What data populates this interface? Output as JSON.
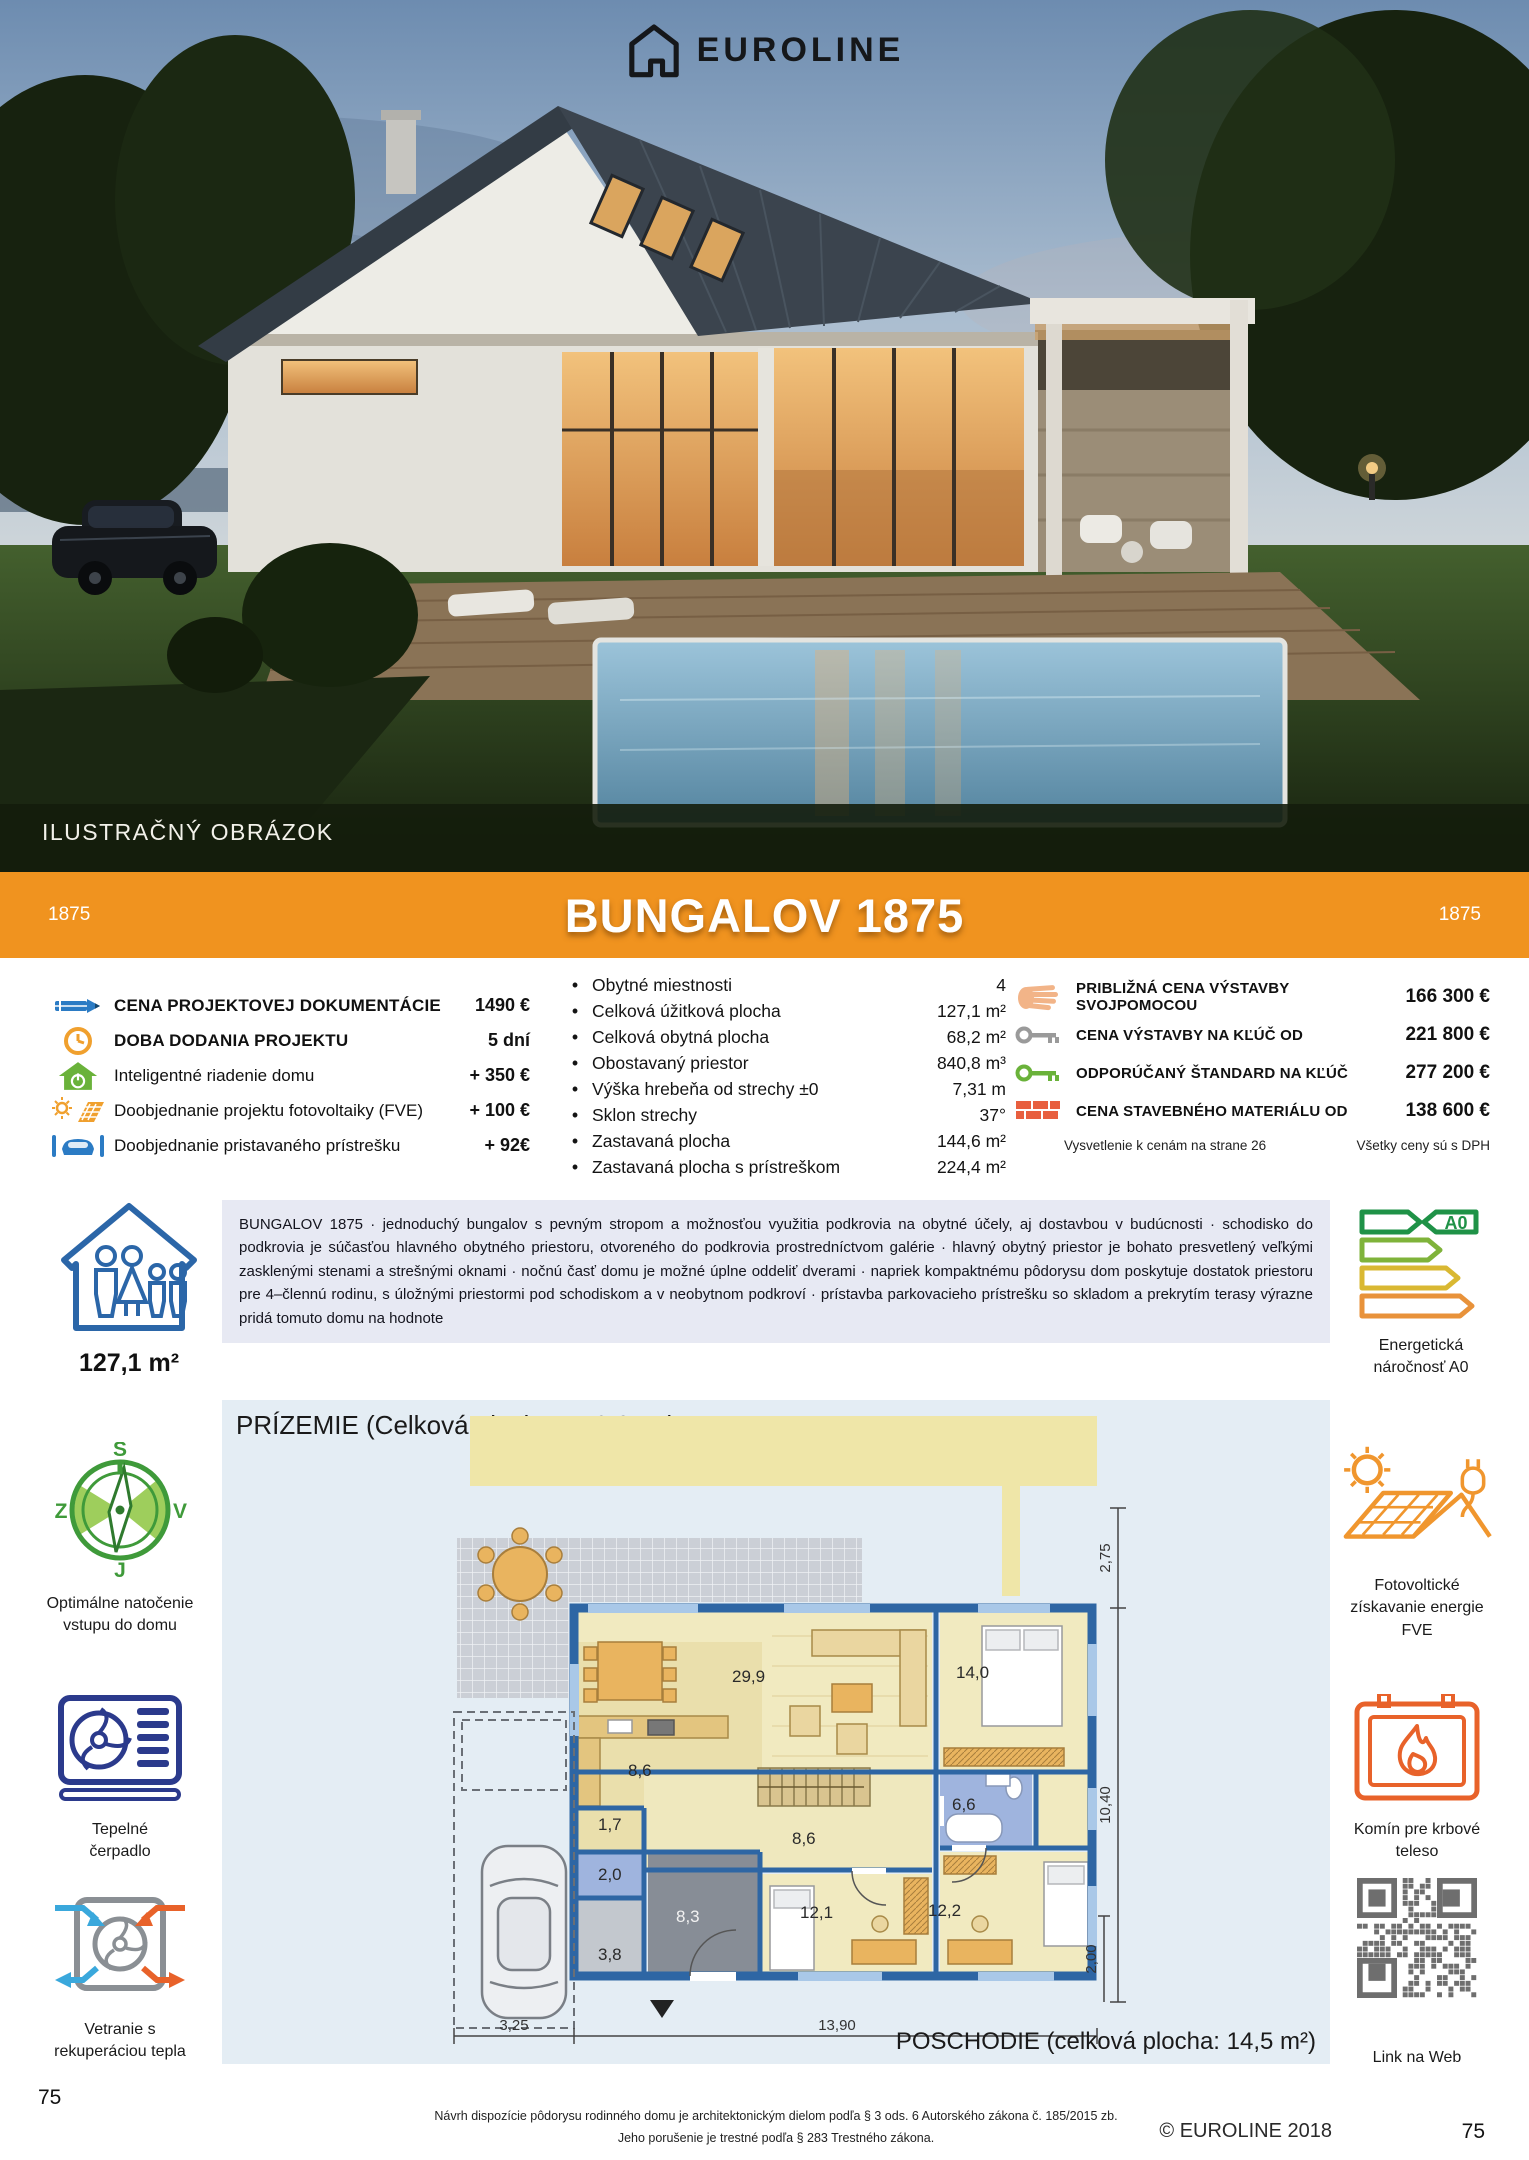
{
  "hero": {
    "brand": "EUROLINE",
    "caption": "ILUSTRAČNÝ OBRÁZOK"
  },
  "banner": {
    "code_left": "1875",
    "title": "BUNGALOV 1875",
    "code_right": "1875",
    "color": "#F0931F"
  },
  "pricing_left": {
    "items": [
      {
        "icon": "pencil-icon",
        "label": "CENA PROJEKTOVEJ DOKUMENTÁCIE",
        "value": "1490 €"
      },
      {
        "icon": "clock-icon",
        "label": "DOBA DODANIA PROJEKTU",
        "value": "5 dní"
      },
      {
        "icon": "smart-home-icon",
        "label": "Inteligentné riadenie domu",
        "value": "+ 350 €"
      },
      {
        "icon": "solar-panel-icon",
        "label": "Doobjednanie projektu fotovoltaiky (FVE)",
        "value": "+ 100 €"
      },
      {
        "icon": "carport-icon",
        "label": "Doobjednanie pristavaného prístrešku",
        "value": "+ 92€"
      }
    ]
  },
  "specs": {
    "items": [
      {
        "label": "Obytné miestnosti",
        "value": "4"
      },
      {
        "label": "Celková úžitková plocha",
        "value": "127,1 m²"
      },
      {
        "label": "Celková obytná plocha",
        "value": "68,2 m²"
      },
      {
        "label": "Obostavaný priestor",
        "value": "840,8 m³"
      },
      {
        "label": "Výška hrebeňa od strechy ±0",
        "value": "7,31 m"
      },
      {
        "label": "Sklon strechy",
        "value": "37°"
      },
      {
        "label": "Zastavaná plocha",
        "value": "144,6 m²"
      },
      {
        "label": "Zastavaná plocha s prístreškom",
        "value": "224,4 m²"
      }
    ]
  },
  "pricing_right": {
    "items": [
      {
        "icon": "hand-icon",
        "label": "PRIBLIŽNÁ CENA VÝSTAVBY SVOJPOMOCOU",
        "value": "166 300 €"
      },
      {
        "icon": "key-gray-icon",
        "label": "CENA VÝSTAVBY NA KĽÚČ OD",
        "value": "221 800 €"
      },
      {
        "icon": "key-green-icon",
        "label": "ODPORÚČANÝ ŠTANDARD NA KĽÚČ",
        "value": "277 200 €"
      },
      {
        "icon": "bricks-icon",
        "label": "CENA STAVEBNÉHO MATERIÁLU OD",
        "value": "138 600 €"
      }
    ],
    "note_left": "Vysvetlenie k cenám na strane 26",
    "note_right": "Všetky ceny sú s DPH"
  },
  "description": {
    "area": "127,1 m²",
    "text": "BUNGALOV 1875 · jednoduchý bungalov s pevným stropom a možnosťou využitia podkrovia na obytné účely, aj dostavbou v budúcnosti · schodisko do podkrovia je súčasťou hlavného obytného priestoru, otvoreného do podkrovia prostredníctvom galérie · hlavný obytný priestor je bohato presvetlený veľkými zasklenými stenami a strešnými oknami · nočnú časť domu je možné úplne oddeliť dverami · napriek kompaktnému pôdorysu dom poskytuje dostatok priestoru pre 4–člennú rodinu, s úložnými priestormi pod schodiskom a v neobytnom podkroví · prístavba parkovacieho prístrešku so skladom a prekrytím terasy výrazne pridá tomuto domu na hodnote",
    "energy_badge": "A0",
    "energy_caption": "Energetická\nnáročnosť A0"
  },
  "features_left": {
    "compass": {
      "caption": "Optimálne natočenie\nvstupu do domu",
      "letters": {
        "n": "S",
        "e": "V",
        "s": "J",
        "w": "Z"
      }
    },
    "heat_pump": {
      "caption": "Tepelné\nčerpadlo"
    },
    "ventilation": {
      "caption": "Vetranie s\nrekuperáciou tepla"
    }
  },
  "features_right": {
    "fve": {
      "caption": "Fotovoltické\nzískavanie energie\nFVE"
    },
    "fireplace": {
      "caption": "Komín pre krbové\nteleso"
    },
    "qr": {
      "caption": "Link na Web"
    }
  },
  "floorplan": {
    "title": "PRÍZEMIE (Celková plocha: 112,6 m²)",
    "upper_floor_note": "POSCHODIE (celková plocha: 14,5 m²)",
    "rooms": [
      "29,9",
      "14,0",
      "8,6",
      "1,7",
      "2,0",
      "8,3",
      "3,8",
      "8,6",
      "12,1",
      "12,2",
      "6,6"
    ],
    "dims": {
      "terrace_depth": "2,75",
      "house_depth": "10,40",
      "rear_offset": "2,00",
      "carport_width": "3,25",
      "house_width": "13,90"
    }
  },
  "footer": {
    "line1": "Návrh dispozície pôdorysu rodinného domu je architektonickým dielom podľa § 3 ods. 6 Autorského zákona č. 185/2015 zb.",
    "line2": "Jeho porušenie je trestné podľa § 283 Trestného zákona.",
    "copyright": "© EUROLINE 2018",
    "page_left": "75",
    "page_right": "75"
  },
  "colors": {
    "accent_orange": "#F0931F",
    "euroline_blue": "#2B66A8",
    "green": "#5FA832",
    "warm_orange": "#F0962E",
    "brick_red": "#E85F3F",
    "desc_bg": "#E7E9F3",
    "plan_bg": "#E4EDF4"
  }
}
